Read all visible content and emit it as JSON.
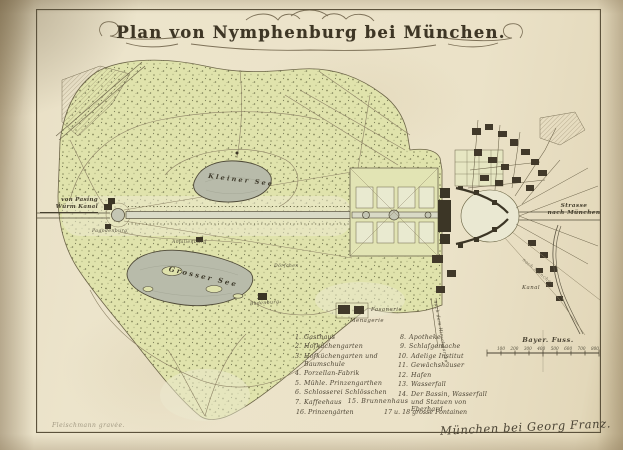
{
  "title": "Plan von Nymphenburg bei München.",
  "colors": {
    "paper": "#ebe2c8",
    "ink": "#4a4232",
    "park_green": "#dfe2ac",
    "water_grey": "#b8bbaa",
    "building_dark": "#3c3626"
  },
  "labels": {
    "kleiner_see": "Kleiner See",
    "grosser_see": "Grosser See",
    "badenburg": "Badenburg",
    "pagodenburg": "Pagodenburg",
    "amalienburg": "Amalienburg",
    "doerfchen": "Dörfchen",
    "fasanerie": "Fasanerie",
    "menagerie": "Menagerie",
    "von_pasing": "von Pasing",
    "wuerm_kanal": "Würm Kanal",
    "strasse": "Strasse",
    "nach_muenchen": "nach München",
    "kanal": "Kanal",
    "hirschgarten": "nach dem Hirschgarten",
    "fussweg": "nach München"
  },
  "scale_bar": {
    "caption": "Bayer. Fuss.",
    "ticks": [
      "100",
      "200",
      "300",
      "400",
      "500",
      "600",
      "700",
      "800"
    ]
  },
  "legend": {
    "col1": [
      {
        "n": "1.",
        "label": "Gasthaus"
      },
      {
        "n": "2.",
        "label": "Hofküchengarten"
      },
      {
        "n": "3.",
        "label": "Hofküchengarten und Baumschule"
      },
      {
        "n": "4.",
        "label": "Porzellan-Fabrik"
      },
      {
        "n": "5.",
        "label": "Mühle. Prinzengarthen"
      },
      {
        "n": "6.",
        "label": "Schlosserei Schlösschen"
      },
      {
        "n": "7.",
        "label": "Kaffeehaus"
      }
    ],
    "col2": [
      {
        "n": "8.",
        "label": "Apotheke"
      },
      {
        "n": "9.",
        "label": "Schlafgemache"
      },
      {
        "n": "10.",
        "label": "Adelige Institut"
      },
      {
        "n": "11.",
        "label": "Gewächshäuser"
      },
      {
        "n": "12.",
        "label": "Hafen"
      },
      {
        "n": "13.",
        "label": "Wasserfall"
      },
      {
        "n": "14.",
        "label": "Der Bassin, Wasserfall und Statuen von Eberhard"
      }
    ],
    "row15": "15. Brunnenhaus",
    "row16": "16. Prinzengärten",
    "row17": "17 u. 18 grosse Fontainen"
  },
  "imprint": "München bei Georg Franz.",
  "engraver": "Fleischmann gravée."
}
